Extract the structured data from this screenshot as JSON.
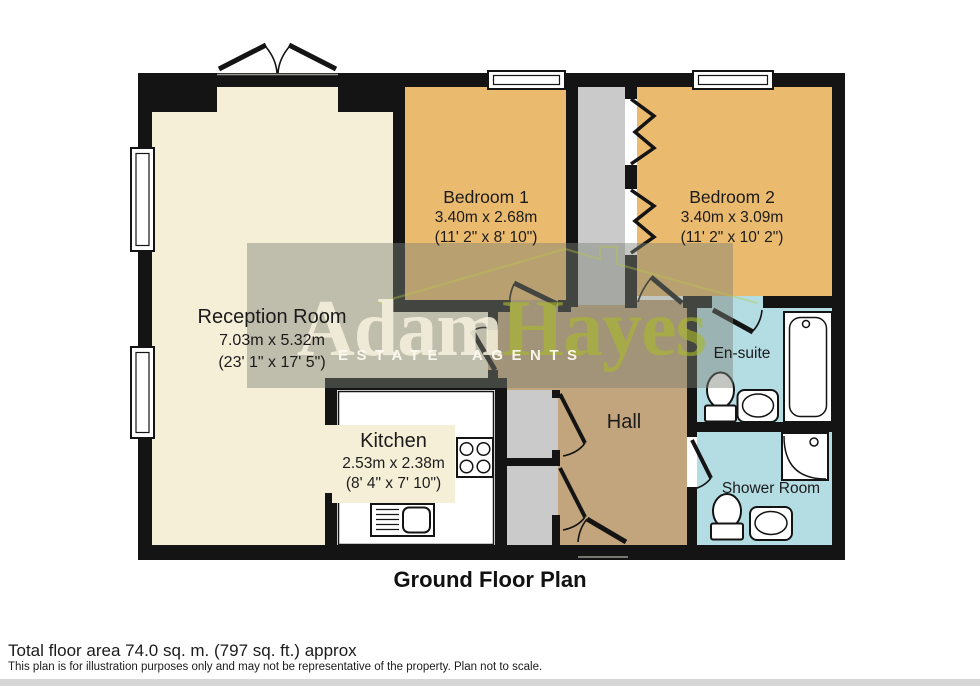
{
  "title": "Ground Floor Plan",
  "footer": {
    "area": "Total floor area 74.0 sq. m. (797 sq. ft.) approx",
    "disclaimer": "This plan is for illustration purposes only and may not be representative of the property. Plan not to scale."
  },
  "watermark": {
    "brand_first": "Adam",
    "brand_second": "Hayes",
    "tagline": "ESTATE AGENTS"
  },
  "rooms": {
    "reception": {
      "name": "Reception Room",
      "metric": "7.03m x 5.32m",
      "imperial": "(23' 1\" x 17' 5\")"
    },
    "bedroom1": {
      "name": "Bedroom 1",
      "metric": "3.40m x 2.68m",
      "imperial": "(11' 2\" x 8' 10\")"
    },
    "bedroom2": {
      "name": "Bedroom 2",
      "metric": "3.40m x 3.09m",
      "imperial": "(11' 2\" x 10' 2\")"
    },
    "kitchen": {
      "name": "Kitchen",
      "metric": "2.53m x 2.38m",
      "imperial": "(8' 4\" x 7' 10\")"
    },
    "hall": {
      "name": "Hall"
    },
    "ensuite": {
      "name": "En-suite"
    },
    "shower": {
      "name": "Shower Room"
    }
  },
  "colors": {
    "wall": "#141414",
    "reception": "#f6efd8",
    "bedroom": "#eaba6e",
    "hall": "#c2a57d",
    "bathroom": "#b4dce3",
    "cupboard": "#cacaca",
    "kitchen_floor": "#ffffff",
    "watermark_cream": "#f6f1dc",
    "watermark_green": "#aab932",
    "tint": "#7d8076"
  }
}
